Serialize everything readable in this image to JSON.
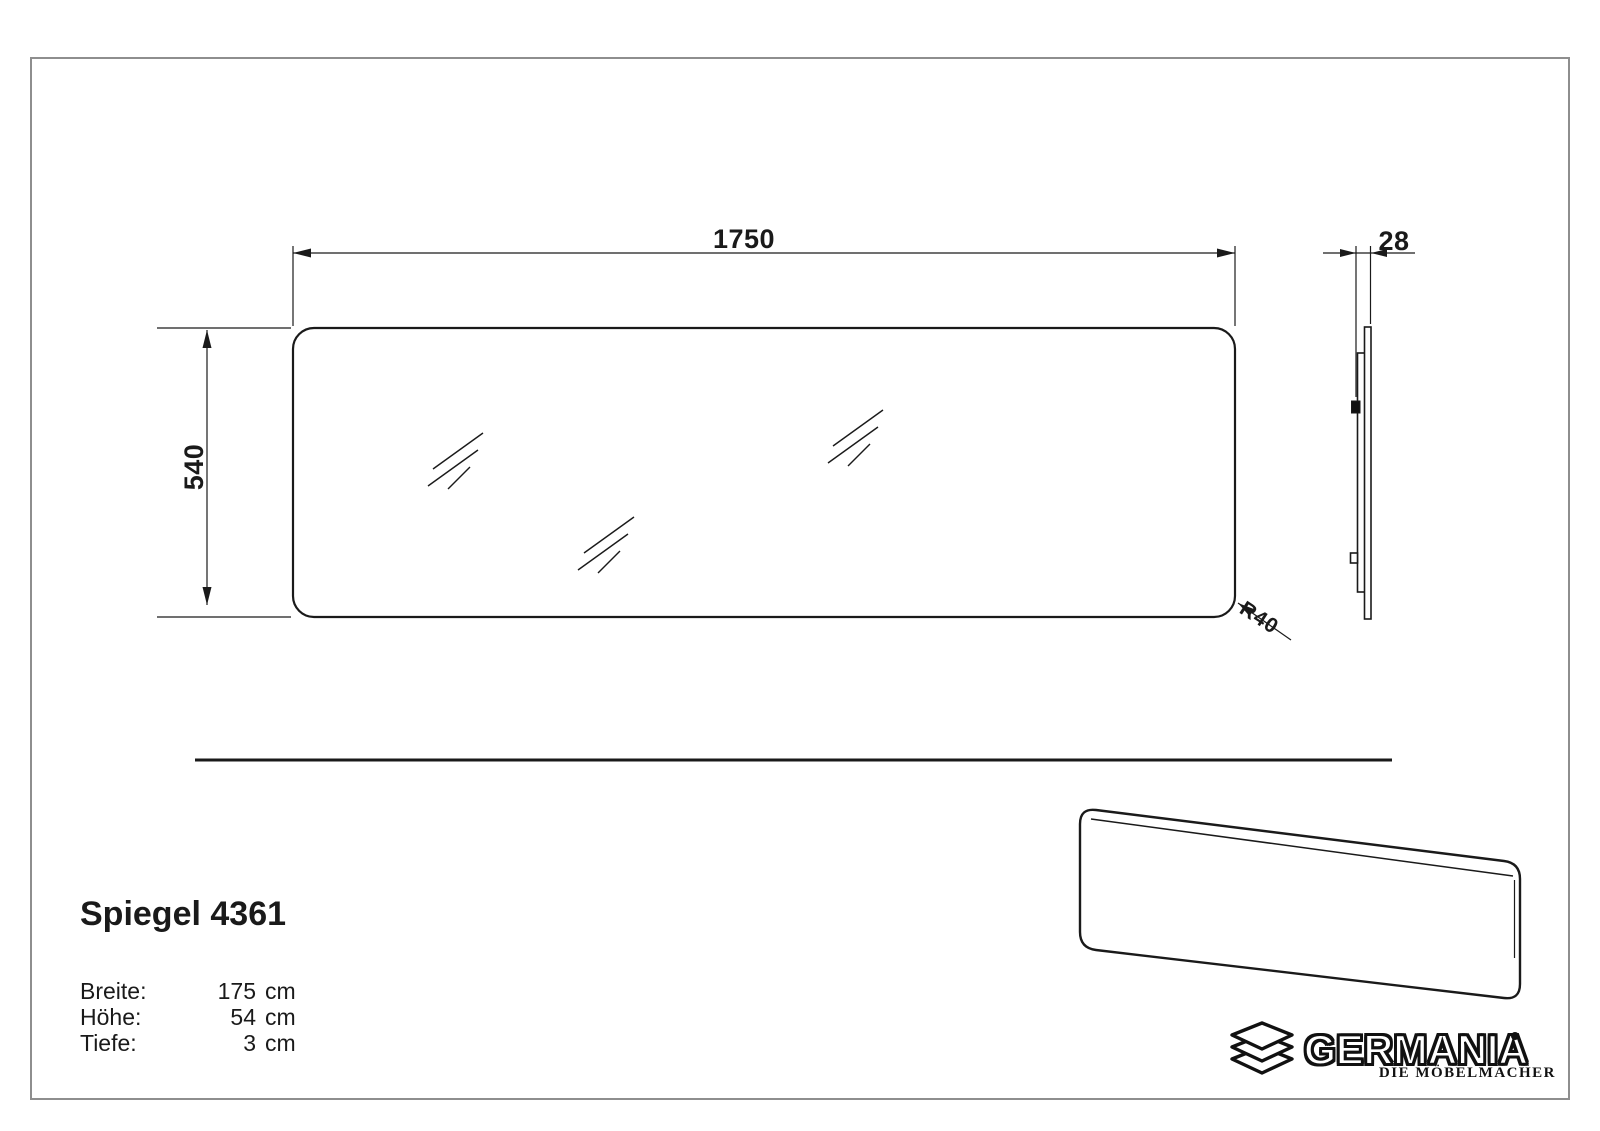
{
  "page": {
    "background": "#ffffff",
    "frame_color": "#8e8e8e",
    "line_color": "#1a1a1a"
  },
  "front_view": {
    "width_label": "1750",
    "height_label": "540",
    "corner_radius_label": "R40"
  },
  "side_view": {
    "depth_label": "28"
  },
  "product": {
    "title": "Spiegel 4361",
    "specs": [
      {
        "label": "Breite:",
        "value": "175",
        "unit": "cm"
      },
      {
        "label": "Höhe:",
        "value": "54",
        "unit": "cm"
      },
      {
        "label": "Tiefe:",
        "value": "3",
        "unit": "cm"
      }
    ]
  },
  "brand": {
    "name": "GERMANIA",
    "tagline": "DIE MÖBELMACHER"
  }
}
